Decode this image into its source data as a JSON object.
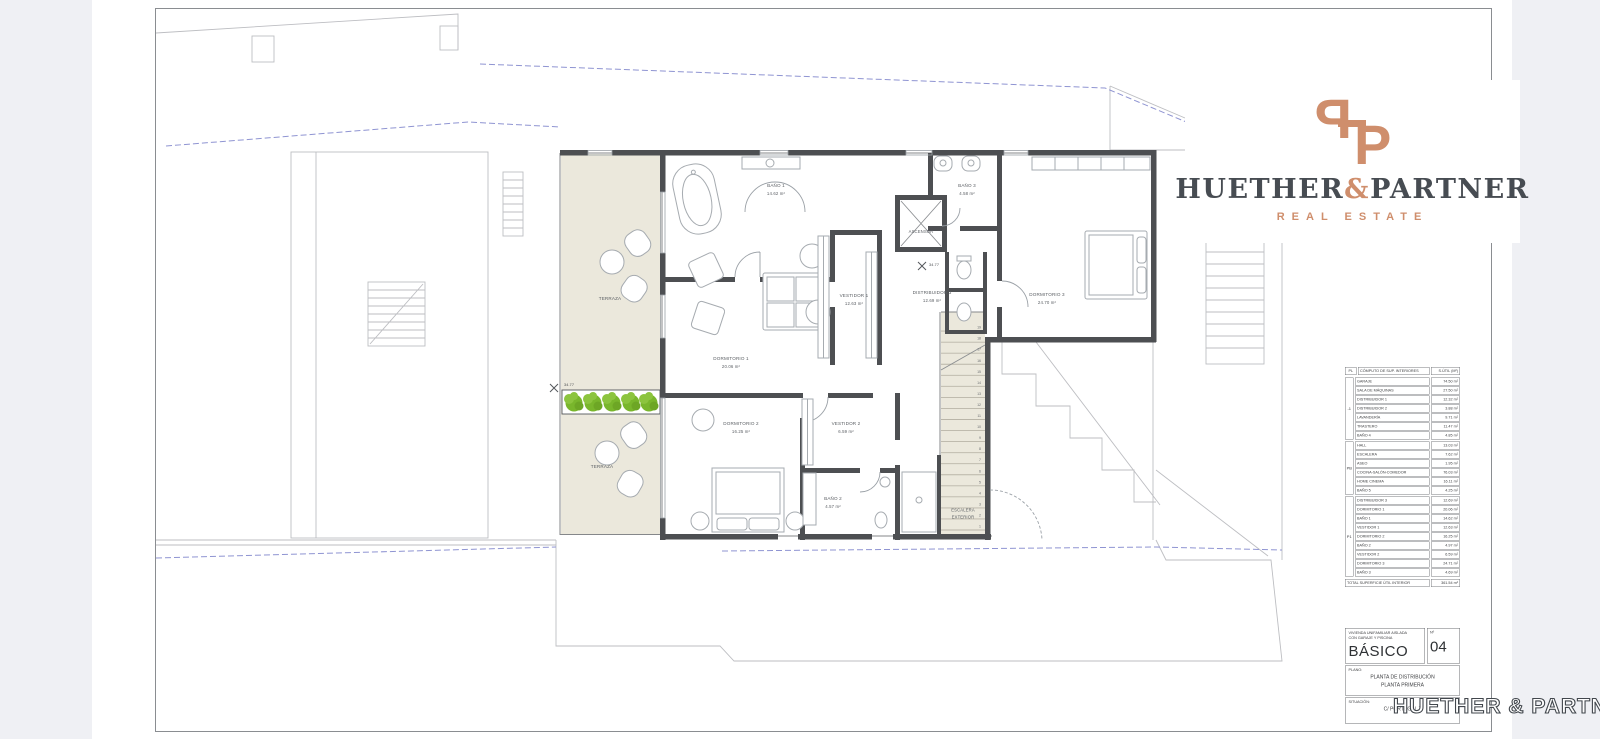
{
  "branding": {
    "monogram_left": "P",
    "monogram_right": "P",
    "name_left": "HUETHER",
    "ampersand": "&",
    "name_right": "PARTNER",
    "tagline": "REAL ESTATE",
    "accent_color": "#cf8e6c",
    "dark_color": "#474c52"
  },
  "watermark": "HUETHER & PARTNER",
  "plan": {
    "rooms": {
      "terraza_upper": {
        "label": "TERRAZA"
      },
      "terraza_lower": {
        "label": "TERRAZA"
      },
      "bano1": {
        "label": "BAÑO 1",
        "area": "14.62 m²"
      },
      "dormitorio1": {
        "label": "DORMITORIO 1",
        "area": "20.06 m²"
      },
      "vestidor1": {
        "label": "VESTIDOR 1",
        "area": "12.63 m²"
      },
      "distribuidor3": {
        "label": "DISTRIBUIDOR 3",
        "area": "12.69 m²"
      },
      "ascensor": {
        "label": "ASCENSOR"
      },
      "bano3": {
        "label": "BAÑO 3",
        "area": "4.58 m²"
      },
      "dormitorio3": {
        "label": "DORMITORIO 3",
        "area": "24.70 m²"
      },
      "dormitorio2": {
        "label": "DORMITORIO 2",
        "area": "16.25 m²"
      },
      "vestidor2": {
        "label": "VESTIDOR 2",
        "area": "6.59 m²"
      },
      "bano2": {
        "label": "BAÑO 2",
        "area": "4.57 m²"
      },
      "escalera_exterior": {
        "label_line1": "ESCALERA",
        "label_line2": "EXTERIOR"
      }
    },
    "level_marks": {
      "planter": "34.77",
      "distribuidor": "34.77"
    },
    "stair_numbers": [
      "1",
      "2",
      "3",
      "4",
      "5",
      "6",
      "7",
      "8",
      "9",
      "10",
      "11",
      "12",
      "13",
      "14",
      "15",
      "16",
      "17",
      "18",
      "19"
    ],
    "planter": {
      "bush_count": 5
    },
    "colors": {
      "terrace_fill": "#ebe8dc",
      "bush_green": "#79b62c",
      "wall": "#4d4f52",
      "site_blue": "#8f94d2"
    }
  },
  "area_table": {
    "header": {
      "floor": "PL",
      "name": "CÓMPUTO DE SUP. INTERIORES",
      "area": "S.ÚTIL (M²)"
    },
    "groups": [
      {
        "floor": "-1",
        "rows": [
          [
            "GARAJE",
            "74.50 m²"
          ],
          [
            "SALA DE MÁQUINAS",
            "27.50 m²"
          ],
          [
            "DISTRIBUIDOR 1",
            "12.32 m²"
          ],
          [
            "DISTRIBUIDOR 2",
            "3.88 m²"
          ],
          [
            "LAVANDERÍA",
            "9.71 m²"
          ],
          [
            "TRASTERO",
            "11.47 m²"
          ],
          [
            "BAÑO 4",
            "4.85 m²"
          ]
        ]
      },
      {
        "floor": "PB",
        "rows": [
          [
            "HALL",
            "13.03 m²"
          ],
          [
            "ESCALERA",
            "7.62 m²"
          ],
          [
            "ASEO",
            "1.95 m²"
          ],
          [
            "COCINA-SALÓN-COMEDOR",
            "76.03 m²"
          ],
          [
            "HOME CINEMA",
            "16.11 m²"
          ],
          [
            "BAÑO 5",
            "4.25 m²"
          ]
        ]
      },
      {
        "floor": "P1",
        "rows": [
          [
            "DISTRIBUIDOR 3",
            "12.69 m²"
          ],
          [
            "DORMITORIO 1",
            "20.06 m²"
          ],
          [
            "BAÑO 1",
            "14.62 m²"
          ],
          [
            "VESTIDOR 1",
            "12.63 m²"
          ],
          [
            "DORMITORIO 2",
            "16.25 m²"
          ],
          [
            "BAÑO 2",
            "4.97 m²"
          ],
          [
            "VESTIDOR 2",
            "6.59 m²"
          ],
          [
            "DORMITORIO 3",
            "24.71 m²"
          ],
          [
            "BAÑO 3",
            "4.69 m²"
          ]
        ]
      }
    ],
    "total": {
      "label": "TOTAL SUPERFICIE ÚTIL INTERIOR",
      "value": "361.54 m²"
    }
  },
  "title_block": {
    "project_line1": "VIVIENDA UNIFAMILIAR AISLADA",
    "project_line2": "CON GARAJE Y PISCINA",
    "phase": "BÁSICO",
    "number_label": "Nº",
    "number": "04",
    "plano_label": "PLANO:",
    "plano_line1": "PLANTA DE DISTRIBUCIÓN",
    "plano_line2": "PLANTA PRIMERA",
    "situacion_label": "SITUACIÓN:",
    "situacion": "C/ PORTUGAL 7"
  }
}
